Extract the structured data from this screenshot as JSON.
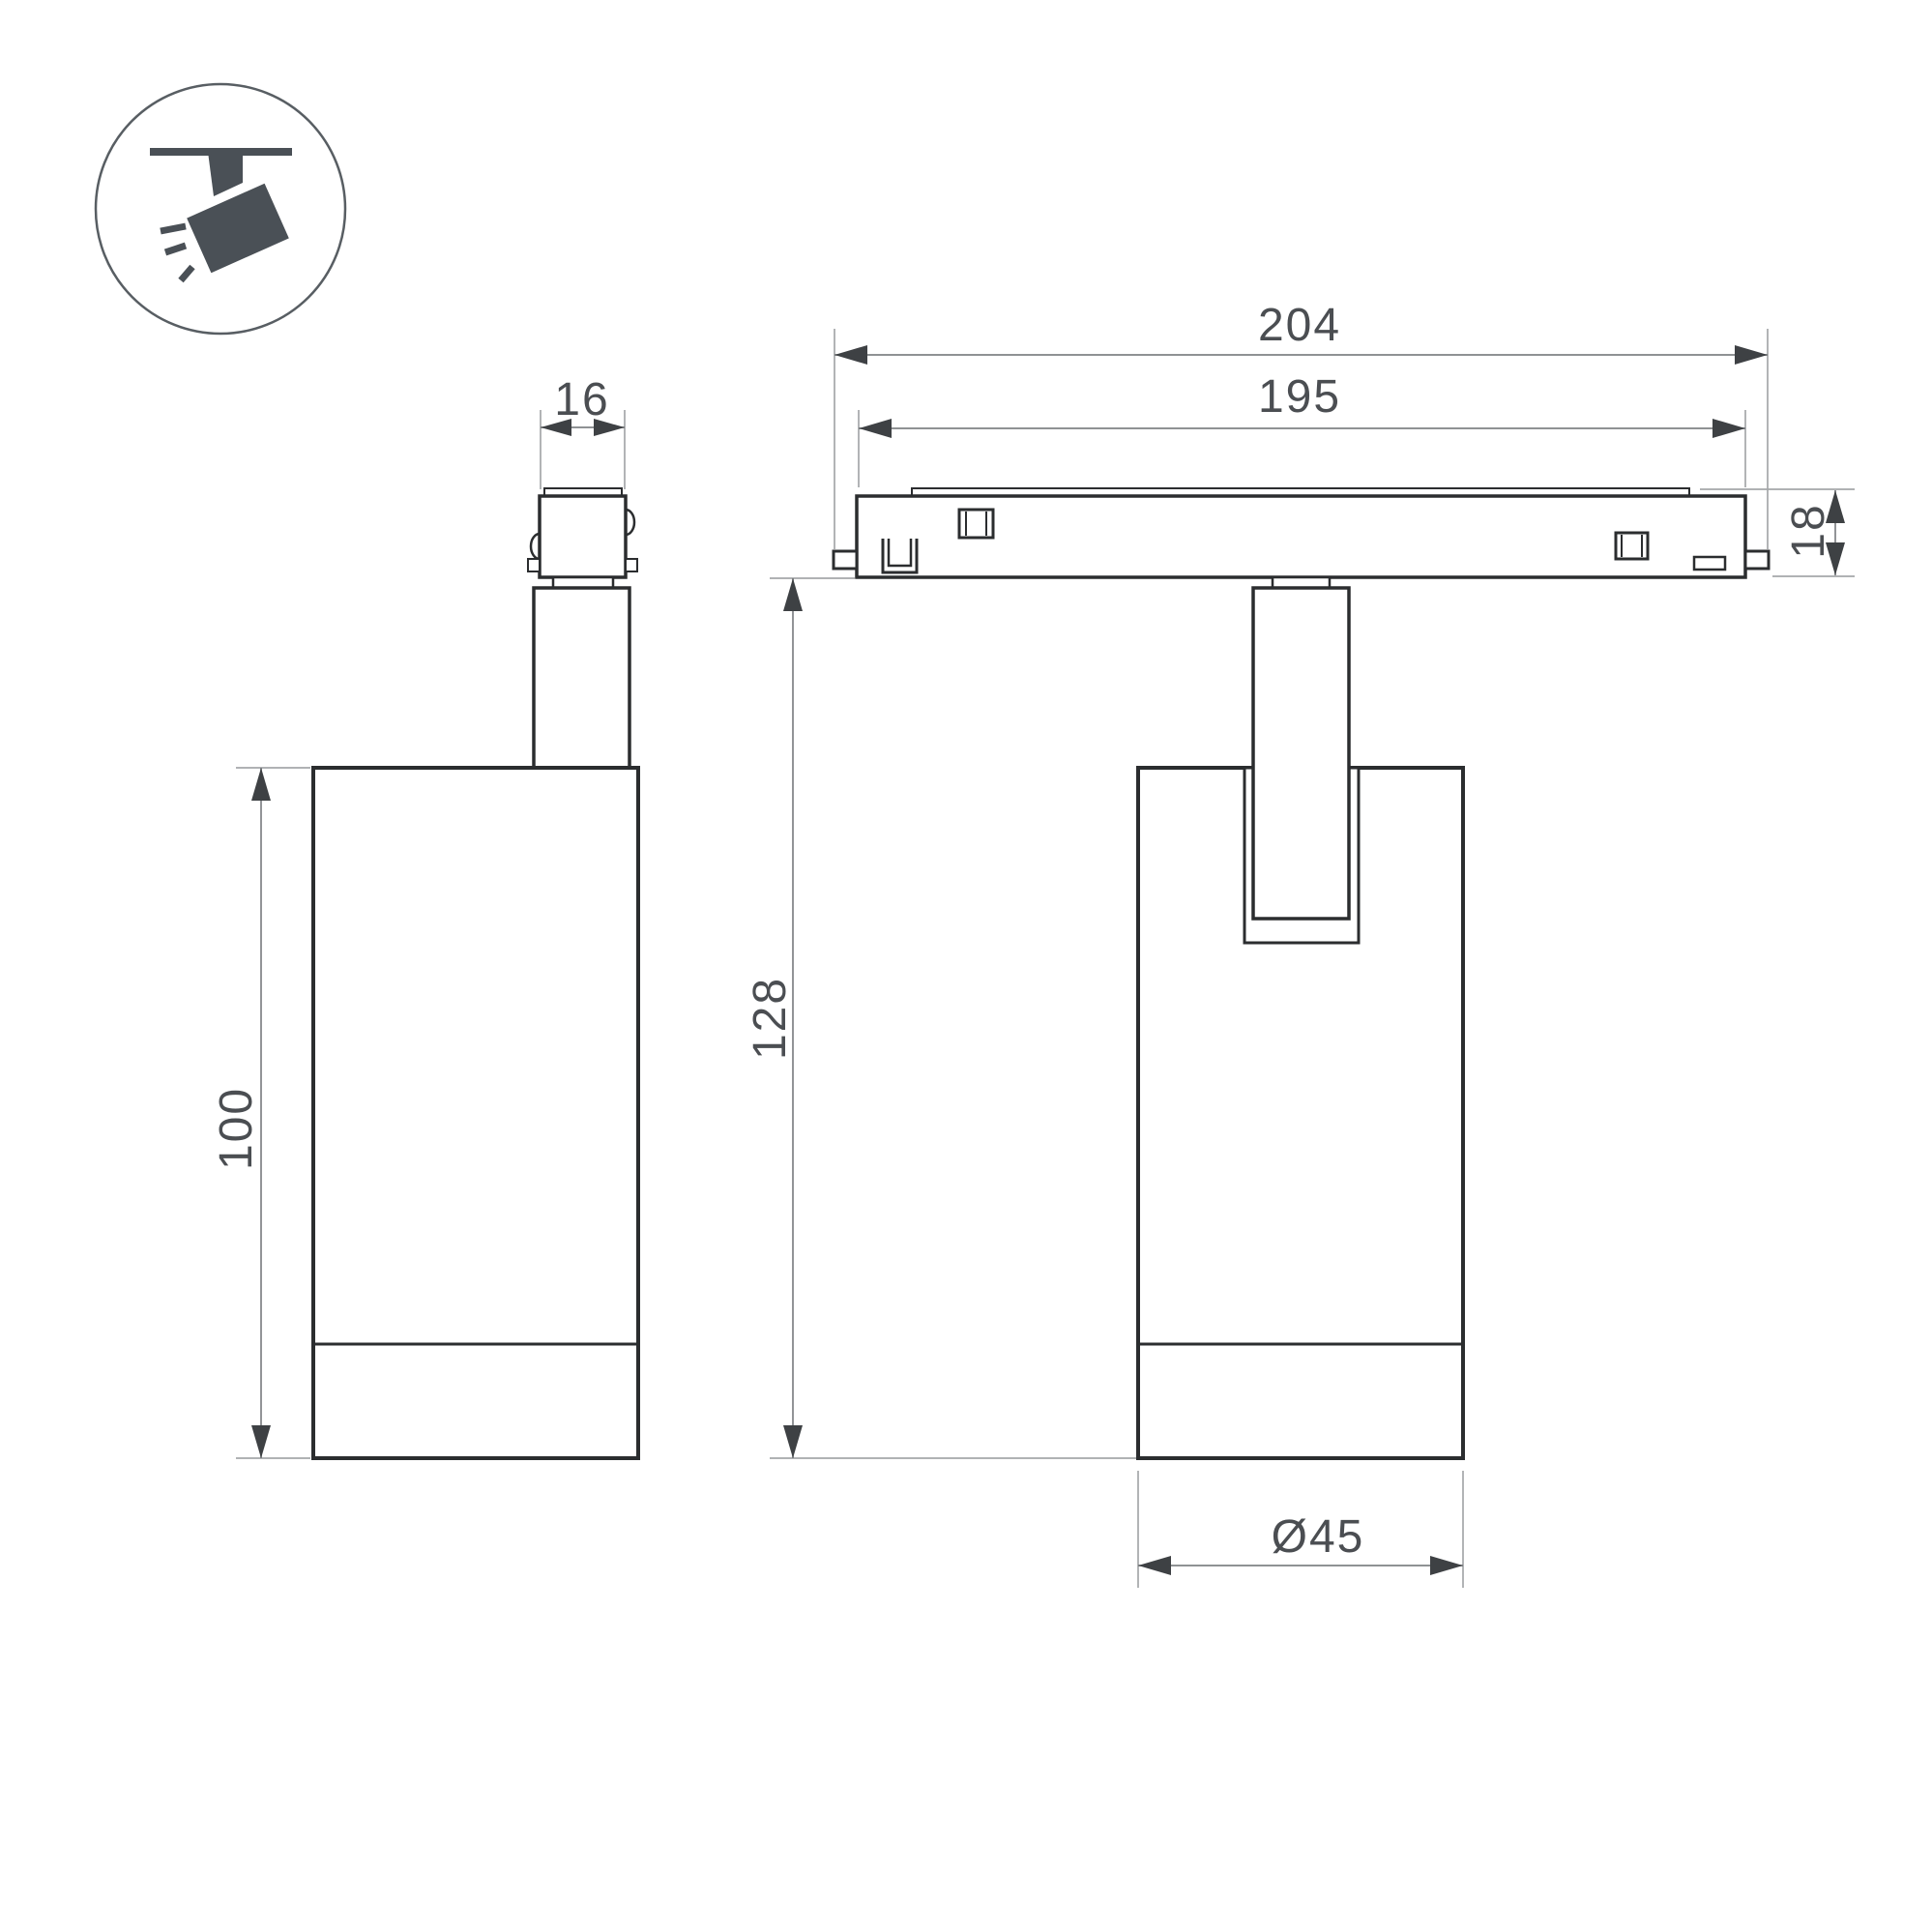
{
  "icon_badge": {
    "name": "ceiling-track-spotlight-pictogram"
  },
  "colors": {
    "background": "#ffffff",
    "outline": "#2b2d2f",
    "dim_line": "#7f8285",
    "ext_line": "#a4a7a9",
    "arrow": "#3e4144",
    "dim_text": "#4b4e52",
    "icon": "#4a5056",
    "icon_circle": "#585e63"
  },
  "dimensions": {
    "adapter_width": "16",
    "track_outer_length": "204",
    "track_inner_length": "195",
    "track_height": "18",
    "suspension_height": "128",
    "body_height": "100",
    "body_diameter": "Ø45"
  }
}
